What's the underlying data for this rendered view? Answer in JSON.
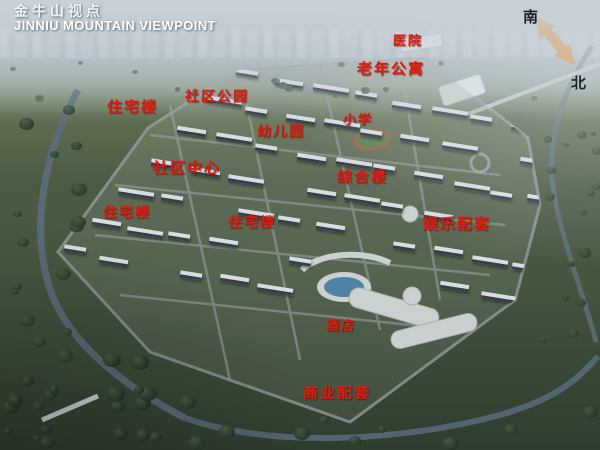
{
  "title": {
    "cn": "金牛山视点",
    "en": "JINNIU MOUNTAIN VIEWPOINT"
  },
  "compass": {
    "south": "南",
    "north": "北"
  },
  "colors": {
    "label_red": "#e4190d",
    "arrow_orange": "#ee7d17",
    "title_white": "#ffffff",
    "river_water": "#5b6d7c",
    "pool_blue": "#3e82b8"
  },
  "map_labels": [
    {
      "id": "residential-a",
      "text": "住宅楼",
      "x": 107,
      "y": 96,
      "size": 15
    },
    {
      "id": "community-park",
      "text": "社区公园",
      "x": 185,
      "y": 86,
      "size": 14
    },
    {
      "id": "kindergarten",
      "text": "幼儿园",
      "x": 257,
      "y": 121,
      "size": 14
    },
    {
      "id": "primary-school",
      "text": "小学",
      "x": 343,
      "y": 109,
      "size": 13
    },
    {
      "id": "hospital",
      "text": "医院",
      "x": 393,
      "y": 30,
      "size": 13
    },
    {
      "id": "senior-apartment",
      "text": "老年公寓",
      "x": 357,
      "y": 58,
      "size": 15
    },
    {
      "id": "community-center",
      "text": "社区中心",
      "x": 153,
      "y": 157,
      "size": 15
    },
    {
      "id": "residential-b",
      "text": "住宅楼",
      "x": 103,
      "y": 202,
      "size": 14
    },
    {
      "id": "residential-c",
      "text": "住宅楼",
      "x": 228,
      "y": 212,
      "size": 14
    },
    {
      "id": "complex-building",
      "text": "综合楼",
      "x": 337,
      "y": 166,
      "size": 15
    },
    {
      "id": "entertainment-facilities",
      "text": "娱乐配套",
      "x": 423,
      "y": 213,
      "size": 15
    },
    {
      "id": "hotel",
      "text": "酒店",
      "x": 326,
      "y": 315,
      "size": 13
    },
    {
      "id": "commercial-facilities",
      "text": "商业配套",
      "x": 303,
      "y": 382,
      "size": 15
    }
  ]
}
